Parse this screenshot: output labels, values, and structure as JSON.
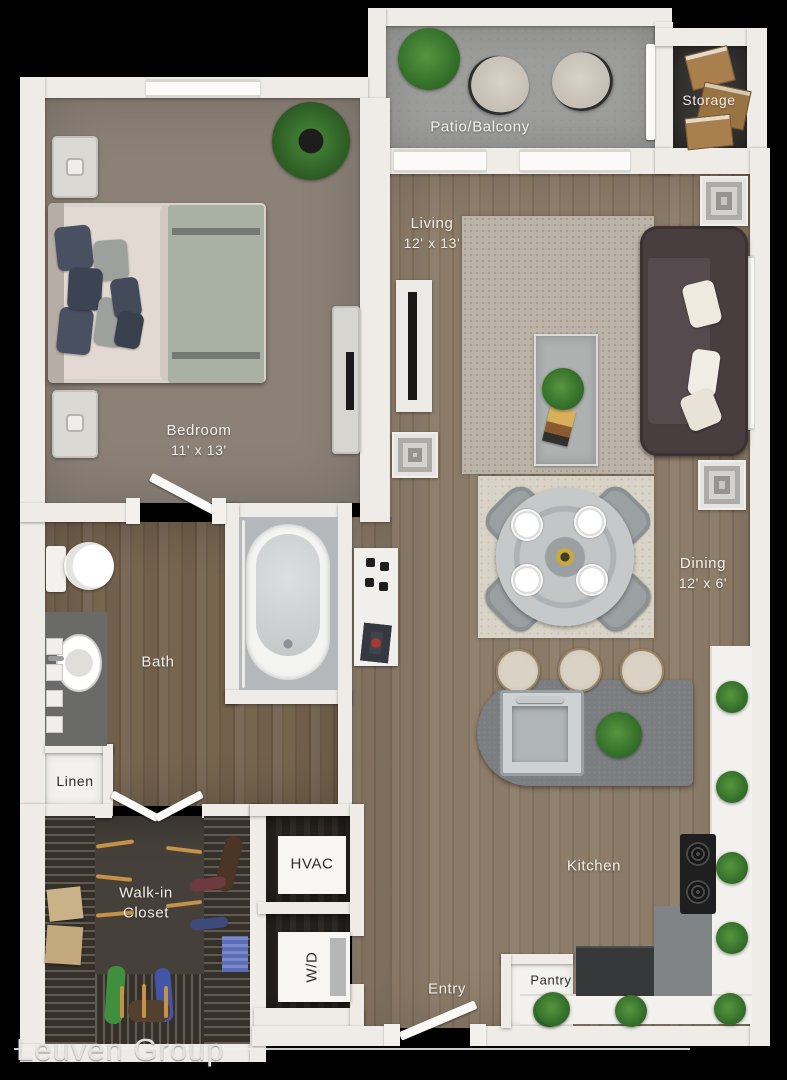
{
  "watermark": "Leuven Group",
  "rooms": {
    "patio": {
      "name": "Patio/Balcony"
    },
    "storage": {
      "name": "Storage"
    },
    "living": {
      "name": "Living",
      "dims": "12' x 13'"
    },
    "bedroom": {
      "name": "Bedroom",
      "dims": "11' x 13'"
    },
    "dining": {
      "name": "Dining",
      "dims": "12' x 6'"
    },
    "bath": {
      "name": "Bath"
    },
    "linen": {
      "name": "Linen"
    },
    "walk_in_closet": {
      "name_line1": "Walk-in",
      "name_line2": "Closet"
    },
    "hvac": {
      "name": "HVAC"
    },
    "washer_dryer": {
      "name": "W/D"
    },
    "entry": {
      "name": "Entry"
    },
    "pantry": {
      "name": "Pantry"
    },
    "kitchen": {
      "name": "Kitchen"
    }
  },
  "colors": {
    "background": "#000000",
    "wall": "#efece7",
    "wood_floor": "#8a7a68",
    "bath_floor": "#76654f",
    "bedroom_carpet": "#8b8177",
    "patio_concrete": "#9d9d9b",
    "utility_floor": "#26231e",
    "closet_floor": "#46403a",
    "island_counter": "#7a7e80",
    "couch": "#483d3f",
    "plant_green": "#3f7a33",
    "label_text": "#f2efe9"
  }
}
